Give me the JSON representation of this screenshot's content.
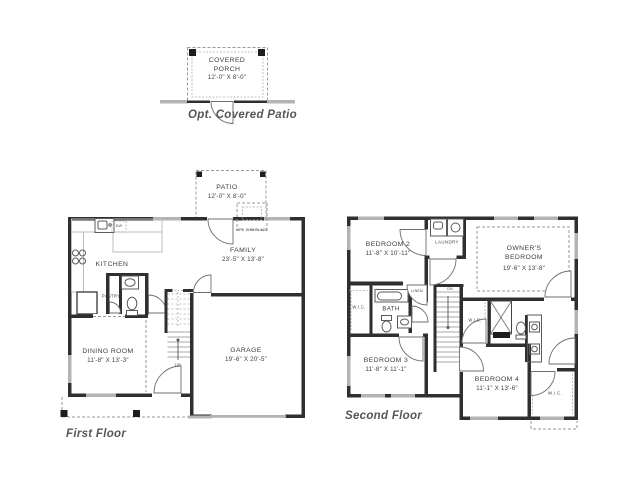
{
  "detail": {
    "caption": "Opt. Covered Patio",
    "name": "COVERED PORCH",
    "dims": "12'-0\" X 8'-0\""
  },
  "first": {
    "caption": "First Floor",
    "patio": {
      "name": "PATIO",
      "dims": "12'-0\" X 8'-0\""
    },
    "family": {
      "name": "FAMILY",
      "dims": "23'-5\" X 13'-8\""
    },
    "kitchen": {
      "name": "KITCHEN"
    },
    "pantry": {
      "name": "PANTRY"
    },
    "dining": {
      "name": "DINING ROOM",
      "dims": "11'-8\" X 13'-3\""
    },
    "garage": {
      "name": "GARAGE",
      "dims": "19'-6\" X 20'-5\""
    },
    "fireplace": "OPT. FIREPLACE",
    "dw": "DW",
    "up": "UP"
  },
  "second": {
    "caption": "Second Floor",
    "bedroom2": {
      "name": "BEDROOM 2",
      "dims": "11'-8\" X 10'-11\""
    },
    "laundry": "LAUNDRY",
    "owners": {
      "name": "OWNER'S BEDROOM",
      "dims": "19'-6\" X 13'-8\""
    },
    "wic_left": "W.I.C.",
    "bath": "BATH",
    "linen": "LINEN",
    "dn": "DN",
    "wic_mid": "W.I.C.",
    "bedroom3": {
      "name": "BEDROOM 3",
      "dims": "11'-8\" X 11'-1\""
    },
    "bedroom4": {
      "name": "BEDROOM 4",
      "dims": "11'-1\" X 13'-6\""
    },
    "wic_right": "W.I.C."
  },
  "colors": {
    "wall": "#2f2f2f",
    "window": "#b3b3b3",
    "label": "#3e3e3e",
    "caption": "#54565a"
  }
}
